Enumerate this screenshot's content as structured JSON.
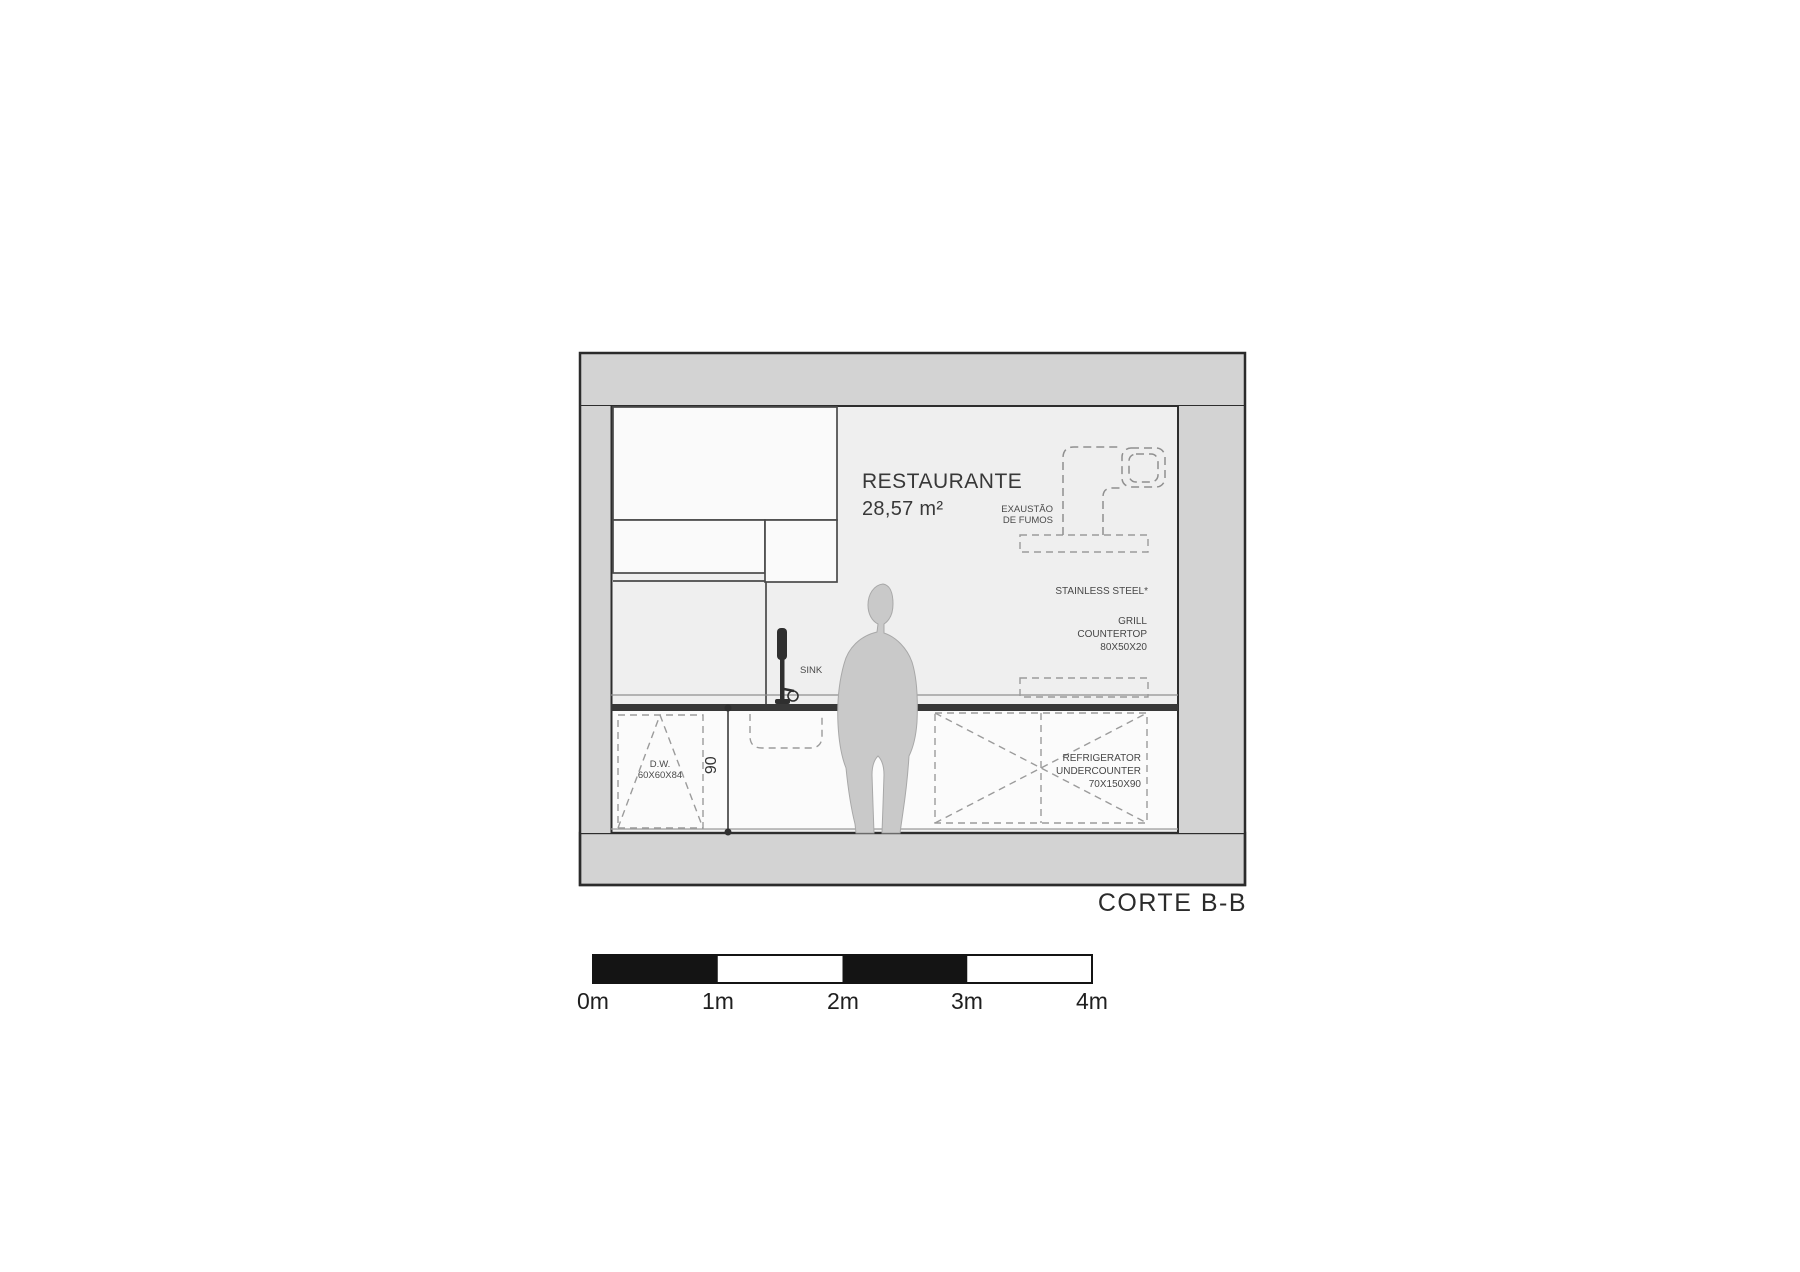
{
  "drawing_title": "CORTE B-B",
  "room": {
    "name": "RESTAURANTE",
    "area": "28,57 m²"
  },
  "annotations": {
    "exhaust": {
      "line1": "EXAUSTÃO",
      "line2": "DE FUMOS"
    },
    "stainless_steel": "STAINLESS STEEL*",
    "grill": {
      "line1": "GRILL",
      "line2": "COUNTERTOP",
      "line3": "80X50X20"
    },
    "sink": "SINK",
    "dishwasher": {
      "line1": "D.W.",
      "line2": "60X60X84"
    },
    "refrigerator": {
      "line1": "REFRIGERATOR",
      "line2": "UNDERCOUNTER",
      "line3": "70X150X90"
    },
    "counter_height_dim": "90"
  },
  "scale_bar": {
    "labels": [
      "0m",
      "1m",
      "2m",
      "3m",
      "4m"
    ]
  },
  "colors": {
    "slab_gray": "#d3d3d3",
    "room_gray": "#efefef",
    "cabinet_white": "#fafafa",
    "line_dark": "#2d2d2d",
    "dash_gray": "#9b9b9b",
    "person_gray": "#c9c9c9",
    "counter_dark": "#383838"
  }
}
